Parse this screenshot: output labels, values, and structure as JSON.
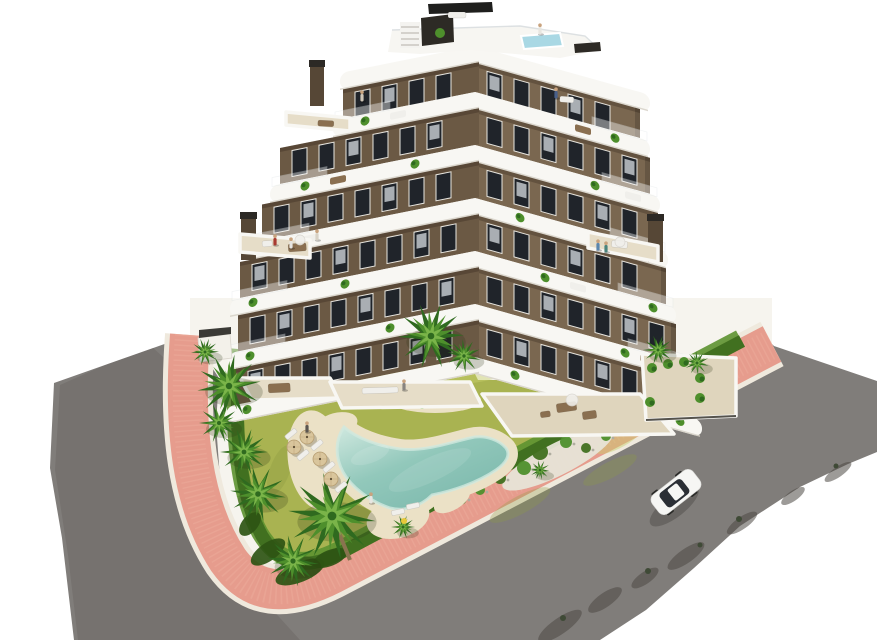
{
  "scene": {
    "kind": "aerial-3d-architectural-render",
    "subject": "modern-apartment-building-with-garden-pool-and-streets"
  },
  "colors": {
    "background": "#ffffff",
    "plot": "#f6f4ee",
    "road": "#807d7a",
    "road_dark": "#5f5b57",
    "curb": "#efe9dd",
    "sidewalk": "#e69c8d",
    "sidewalk_light": "#f2b6a5",
    "lawn": "#a9b351",
    "lawn_light": "#c7d06c",
    "lawn_dark": "#8d9c41",
    "hedge": "#417020",
    "hedge_light": "#5d9230",
    "bush_dark": "#2e5414",
    "gravel": "#e7e4d7",
    "pebble": "#b0ada0",
    "sand": "#ebe1c6",
    "sand_shadow": "#d9cca8",
    "pool_edge": "#cfe8df",
    "pool_mid": "#92c8bb",
    "pool_deep": "#7ab7ab",
    "rooftop_pool": "#a9d8e4",
    "facade_left": "#6b5944",
    "facade_right": "#7a6750",
    "band": "#f8f7f3",
    "band_edge": "#d6d1c7",
    "window": "#20242a",
    "window_frame": "#e9e7e1",
    "curtain": "#ccd1d6",
    "roof_white": "#f7f6f2",
    "dark_panel": "#2d2a25",
    "black": "#1f1f1d",
    "terrace_floor": "#e6ddc8",
    "terrace_floor2": "#dfd5bd",
    "wicker": "#8a6f50",
    "white_furn": "#f0efeb",
    "palm_dark": "#2f6a1f",
    "palm_mid": "#4e8f2c",
    "palm_light": "#7ab449",
    "trunk": "#8a734f",
    "umbrella": "#d9c59c",
    "umbrella_dark": "#b79e72",
    "shadow": "#4c4944",
    "car_body": "#f6f6f4",
    "car_glass": "#2b2f35",
    "skin": "#c9a37e",
    "float_yellow": "#e8c93a",
    "chimney": "#564736",
    "chimney_cap": "#2c2925"
  },
  "building": {
    "corner_x": 475,
    "left_skew_deg": -11.3,
    "right_skew_deg": 15.6,
    "band_h": 17,
    "roof_band_y": 46,
    "roof_left": -125,
    "roof_right": 165,
    "floors": [
      {
        "fy": 63,
        "fh": 29,
        "band_y": 92,
        "left": -132,
        "right": 165
      },
      {
        "fy": 109,
        "fh": 36,
        "band_y": 145,
        "left": -195,
        "right": 175
      },
      {
        "fy": 162,
        "fh": 36,
        "band_y": 198,
        "left": -213,
        "right": 183
      },
      {
        "fy": 215,
        "fh": 36,
        "band_y": 251,
        "left": -235,
        "right": 191
      },
      {
        "fy": 268,
        "fh": 36,
        "band_y": 304,
        "left": -237,
        "right": 201
      },
      {
        "fy": 321,
        "fh": 36,
        "band_y": 357,
        "left": -239,
        "right": 217
      }
    ],
    "window": {
      "w": 15,
      "h": 26,
      "gap": 27,
      "margin": 12
    },
    "band_plants": [
      [
        -110,
        140
      ],
      [
        -170,
        -60,
        120
      ],
      [
        -195,
        45,
        160
      ],
      [
        -222,
        -130,
        70,
        178
      ],
      [
        -225,
        -85,
        150,
        188
      ],
      [
        -228,
        40,
        205
      ]
    ],
    "band_furniture": [
      {
        "f": 0,
        "x": -85,
        "c": "white_furn"
      },
      {
        "f": 0,
        "x": 100,
        "c": "wicker"
      },
      {
        "f": 1,
        "x": -145,
        "c": "wicker"
      },
      {
        "f": 1,
        "x": 150,
        "c": "white_furn"
      },
      {
        "f": 2,
        "x": -175,
        "c": "white_furn"
      },
      {
        "f": 3,
        "x": 95,
        "c": "white_furn"
      },
      {
        "f": 4,
        "x": 165,
        "c": "wicker"
      }
    ],
    "chimneys": [
      {
        "x": 241,
        "y": 212,
        "w": 15,
        "h": 48
      },
      {
        "x": 648,
        "y": 214,
        "w": 15,
        "h": 48
      },
      {
        "x": 310,
        "y": 60,
        "w": 14,
        "h": 46
      }
    ]
  },
  "terraces": [
    {
      "name": "terrace-ground-left",
      "pts": "240,378 330,378 342,398 252,400",
      "fill": "terrace_floor"
    },
    {
      "name": "terrace-ground-mid",
      "pts": "330,382 470,382 482,406 342,408",
      "fill": "terrace_floor"
    },
    {
      "name": "terrace-ground-right",
      "pts": "482,394 640,394 674,434 512,436",
      "fill": "terrace_floor2"
    },
    {
      "name": "terrace-annex",
      "pts": "642,354 736,358 736,416 646,420",
      "fill": "terrace_floor2"
    },
    {
      "name": "terrace-floor3-left",
      "pts": "240,234 310,240 310,258 240,252",
      "fill": "terrace_floor"
    },
    {
      "name": "terrace-floor3-right",
      "pts": "588,232 658,246 658,262 588,248",
      "fill": "terrace_floor"
    },
    {
      "name": "terrace-floor5-left",
      "pts": "286,112 350,118 350,131 286,125",
      "fill": "terrace_floor"
    }
  ],
  "furniture": [
    {
      "x": 268,
      "y": 384,
      "w": 22,
      "h": 9,
      "rot": -3,
      "c": "wicker"
    },
    {
      "x": 362,
      "y": 388,
      "w": 36,
      "h": 6,
      "rot": -2,
      "c": "white_furn"
    },
    {
      "x": 556,
      "y": 404,
      "w": 20,
      "h": 9,
      "rot": -8,
      "c": "wicker"
    },
    {
      "x": 582,
      "y": 412,
      "w": 14,
      "h": 8,
      "rot": -8,
      "c": "wicker"
    },
    {
      "x": 540,
      "y": 412,
      "w": 10,
      "h": 6,
      "rot": -8,
      "c": "wicker"
    },
    {
      "x": 288,
      "y": 244,
      "w": 18,
      "h": 8,
      "rot": -4,
      "c": "wicker"
    },
    {
      "x": 262,
      "y": 241,
      "w": 10,
      "h": 6,
      "rot": -4,
      "c": "white_furn"
    },
    {
      "x": 612,
      "y": 240,
      "w": 16,
      "h": 7,
      "rot": 6,
      "c": "white_furn"
    },
    {
      "x": 318,
      "y": 120,
      "w": 16,
      "h": 6,
      "rot": 3,
      "c": "wicker"
    },
    {
      "x": 560,
      "y": 96,
      "w": 14,
      "h": 6,
      "rot": 4,
      "c": "white_furn"
    },
    {
      "x": 448,
      "y": 12,
      "w": 18,
      "h": 6,
      "rot": 0,
      "c": "white_furn"
    }
  ],
  "parasols": [
    {
      "x": 572,
      "y": 400,
      "r": 6
    },
    {
      "x": 300,
      "y": 240,
      "r": 5
    },
    {
      "x": 620,
      "y": 242,
      "r": 5
    }
  ],
  "planters": [
    {
      "x": 652,
      "y": 368
    },
    {
      "x": 668,
      "y": 364
    },
    {
      "x": 684,
      "y": 362
    },
    {
      "x": 700,
      "y": 378
    },
    {
      "x": 650,
      "y": 402
    },
    {
      "x": 700,
      "y": 398
    }
  ],
  "palms": [
    {
      "x": 205,
      "y": 352,
      "r": 14
    },
    {
      "x": 229,
      "y": 386,
      "r": 32
    },
    {
      "x": 219,
      "y": 423,
      "r": 20
    },
    {
      "x": 244,
      "y": 452,
      "r": 24
    },
    {
      "x": 258,
      "y": 494,
      "r": 28
    },
    {
      "x": 332,
      "y": 516,
      "r": 44
    },
    {
      "x": 293,
      "y": 561,
      "r": 26
    },
    {
      "x": 403,
      "y": 527,
      "r": 12
    },
    {
      "x": 431,
      "y": 336,
      "r": 33
    },
    {
      "x": 464,
      "y": 356,
      "r": 17
    },
    {
      "x": 540,
      "y": 470,
      "r": 10
    },
    {
      "x": 658,
      "y": 350,
      "r": 15
    },
    {
      "x": 697,
      "y": 363,
      "r": 12
    }
  ],
  "people": [
    {
      "x": 275,
      "y": 243,
      "c": "#a83a30"
    },
    {
      "x": 291,
      "y": 246,
      "c": "#e6e4e0"
    },
    {
      "x": 317,
      "y": 238,
      "c": "#d8d2c6"
    },
    {
      "x": 598,
      "y": 248,
      "c": "#5b86ad"
    },
    {
      "x": 606,
      "y": 250,
      "c": "#4a837c"
    },
    {
      "x": 362,
      "y": 99,
      "c": "#cfc6b8"
    },
    {
      "x": 540,
      "y": 32,
      "c": "#e8e6e0"
    },
    {
      "x": 556,
      "y": 96,
      "c": "#49608a"
    },
    {
      "x": 307,
      "y": 430,
      "c": "#5a5550"
    },
    {
      "x": 371,
      "y": 501,
      "c": "#e8e6e2"
    },
    {
      "x": 404,
      "y": 388,
      "c": "#888480"
    }
  ],
  "umbrellas": [
    {
      "x": 307,
      "y": 437
    },
    {
      "x": 320,
      "y": 459
    },
    {
      "x": 331,
      "y": 479
    },
    {
      "x": 294,
      "y": 447
    }
  ],
  "loungers": [
    {
      "x": 317,
      "y": 445,
      "rot": -40
    },
    {
      "x": 329,
      "y": 467,
      "rot": -40
    },
    {
      "x": 341,
      "y": 487,
      "rot": -40
    },
    {
      "x": 303,
      "y": 455,
      "rot": -40
    },
    {
      "x": 291,
      "y": 434,
      "rot": -40
    },
    {
      "x": 398,
      "y": 512,
      "rot": -12
    },
    {
      "x": 413,
      "y": 506,
      "rot": -12
    }
  ],
  "pool_float": {
    "x": 404,
    "y": 521,
    "r": 3
  },
  "lawn_patches": [
    {
      "x": 310,
      "y": 385,
      "rx": 45,
      "ry": 11,
      "rot": -5,
      "c": "lawn_light",
      "o": 0.5
    },
    {
      "x": 450,
      "y": 375,
      "rx": 55,
      "ry": 10,
      "rot": -3,
      "c": "lawn_light",
      "o": 0.45
    },
    {
      "x": 570,
      "y": 402,
      "rx": 40,
      "ry": 11,
      "rot": -20,
      "c": "lawn_light",
      "o": 0.4
    },
    {
      "x": 620,
      "y": 438,
      "rx": 28,
      "ry": 9,
      "rot": -30,
      "c": "lawn_light",
      "o": 0.45
    },
    {
      "x": 280,
      "y": 470,
      "rx": 26,
      "ry": 10,
      "rot": -70,
      "c": "lawn_dark",
      "o": 0.35
    },
    {
      "x": 520,
      "y": 505,
      "rx": 34,
      "ry": 9,
      "rot": -28,
      "c": "lawn_dark",
      "o": 0.3
    },
    {
      "x": 610,
      "y": 470,
      "rx": 30,
      "ry": 8,
      "rot": -28,
      "c": "lawn_dark",
      "o": 0.3
    },
    {
      "x": 350,
      "y": 545,
      "rx": 26,
      "ry": 8,
      "rot": -25,
      "c": "lawn_dark",
      "o": 0.3
    }
  ],
  "sand_aprons": [
    {
      "x": 316,
      "y": 460,
      "rx": 28,
      "ry": 50,
      "rot": -8
    },
    {
      "x": 398,
      "y": 518,
      "rx": 32,
      "ry": 20,
      "rot": -15
    },
    {
      "x": 336,
      "y": 425,
      "rx": 22,
      "ry": 12,
      "rot": -15
    },
    {
      "x": 452,
      "y": 500,
      "rx": 20,
      "ry": 10,
      "rot": -30
    }
  ],
  "corner_bushes": [
    {
      "x": 300,
      "y": 572,
      "rx": 26,
      "ry": 10,
      "rot": -22
    },
    {
      "x": 268,
      "y": 552,
      "rx": 20,
      "ry": 9,
      "rot": -35
    },
    {
      "x": 330,
      "y": 558,
      "rx": 18,
      "ry": 8,
      "rot": -22
    },
    {
      "x": 250,
      "y": 524,
      "rx": 14,
      "ry": 8,
      "rot": -50
    }
  ],
  "gravel_bushes": [
    {
      "x": 540,
      "y": 452,
      "r": 8
    },
    {
      "x": 566,
      "y": 442,
      "r": 6
    },
    {
      "x": 586,
      "y": 448,
      "r": 5
    },
    {
      "x": 524,
      "y": 468,
      "r": 7
    },
    {
      "x": 500,
      "y": 478,
      "r": 6
    },
    {
      "x": 606,
      "y": 436,
      "r": 5
    },
    {
      "x": 460,
      "y": 498,
      "r": 7
    },
    {
      "x": 480,
      "y": 490,
      "r": 5
    }
  ],
  "island_shrubs": [
    {
      "x": 414,
      "y": 396,
      "r": 7
    },
    {
      "x": 432,
      "y": 392,
      "r": 8
    },
    {
      "x": 451,
      "y": 397,
      "r": 6
    },
    {
      "x": 422,
      "y": 404,
      "r": 5
    },
    {
      "x": 444,
      "y": 403,
      "r": 4
    }
  ],
  "island_rocks": [
    {
      "x": 405,
      "y": 403
    },
    {
      "x": 462,
      "y": 400
    },
    {
      "x": 398,
      "y": 396
    }
  ],
  "road_shadows": [
    {
      "x": 560,
      "y": 626,
      "rx": 26,
      "ry": 8
    },
    {
      "x": 605,
      "y": 600,
      "rx": 20,
      "ry": 7
    },
    {
      "x": 645,
      "y": 578,
      "rx": 16,
      "ry": 6
    },
    {
      "x": 686,
      "y": 556,
      "rx": 22,
      "ry": 7
    },
    {
      "x": 742,
      "y": 523,
      "rx": 18,
      "ry": 6
    },
    {
      "x": 793,
      "y": 496,
      "rx": 14,
      "ry": 5
    },
    {
      "x": 838,
      "y": 472,
      "rx": 16,
      "ry": 5
    }
  ],
  "road_bushes": [
    {
      "x": 563,
      "y": 618,
      "r": 3
    },
    {
      "x": 648,
      "y": 571,
      "r": 3
    },
    {
      "x": 739,
      "y": 519,
      "r": 3
    },
    {
      "x": 836,
      "y": 466,
      "r": 2.5
    },
    {
      "x": 700,
      "y": 545,
      "r": 2.5
    }
  ],
  "car": {
    "x": 676,
    "y": 492,
    "rot": -38
  }
}
